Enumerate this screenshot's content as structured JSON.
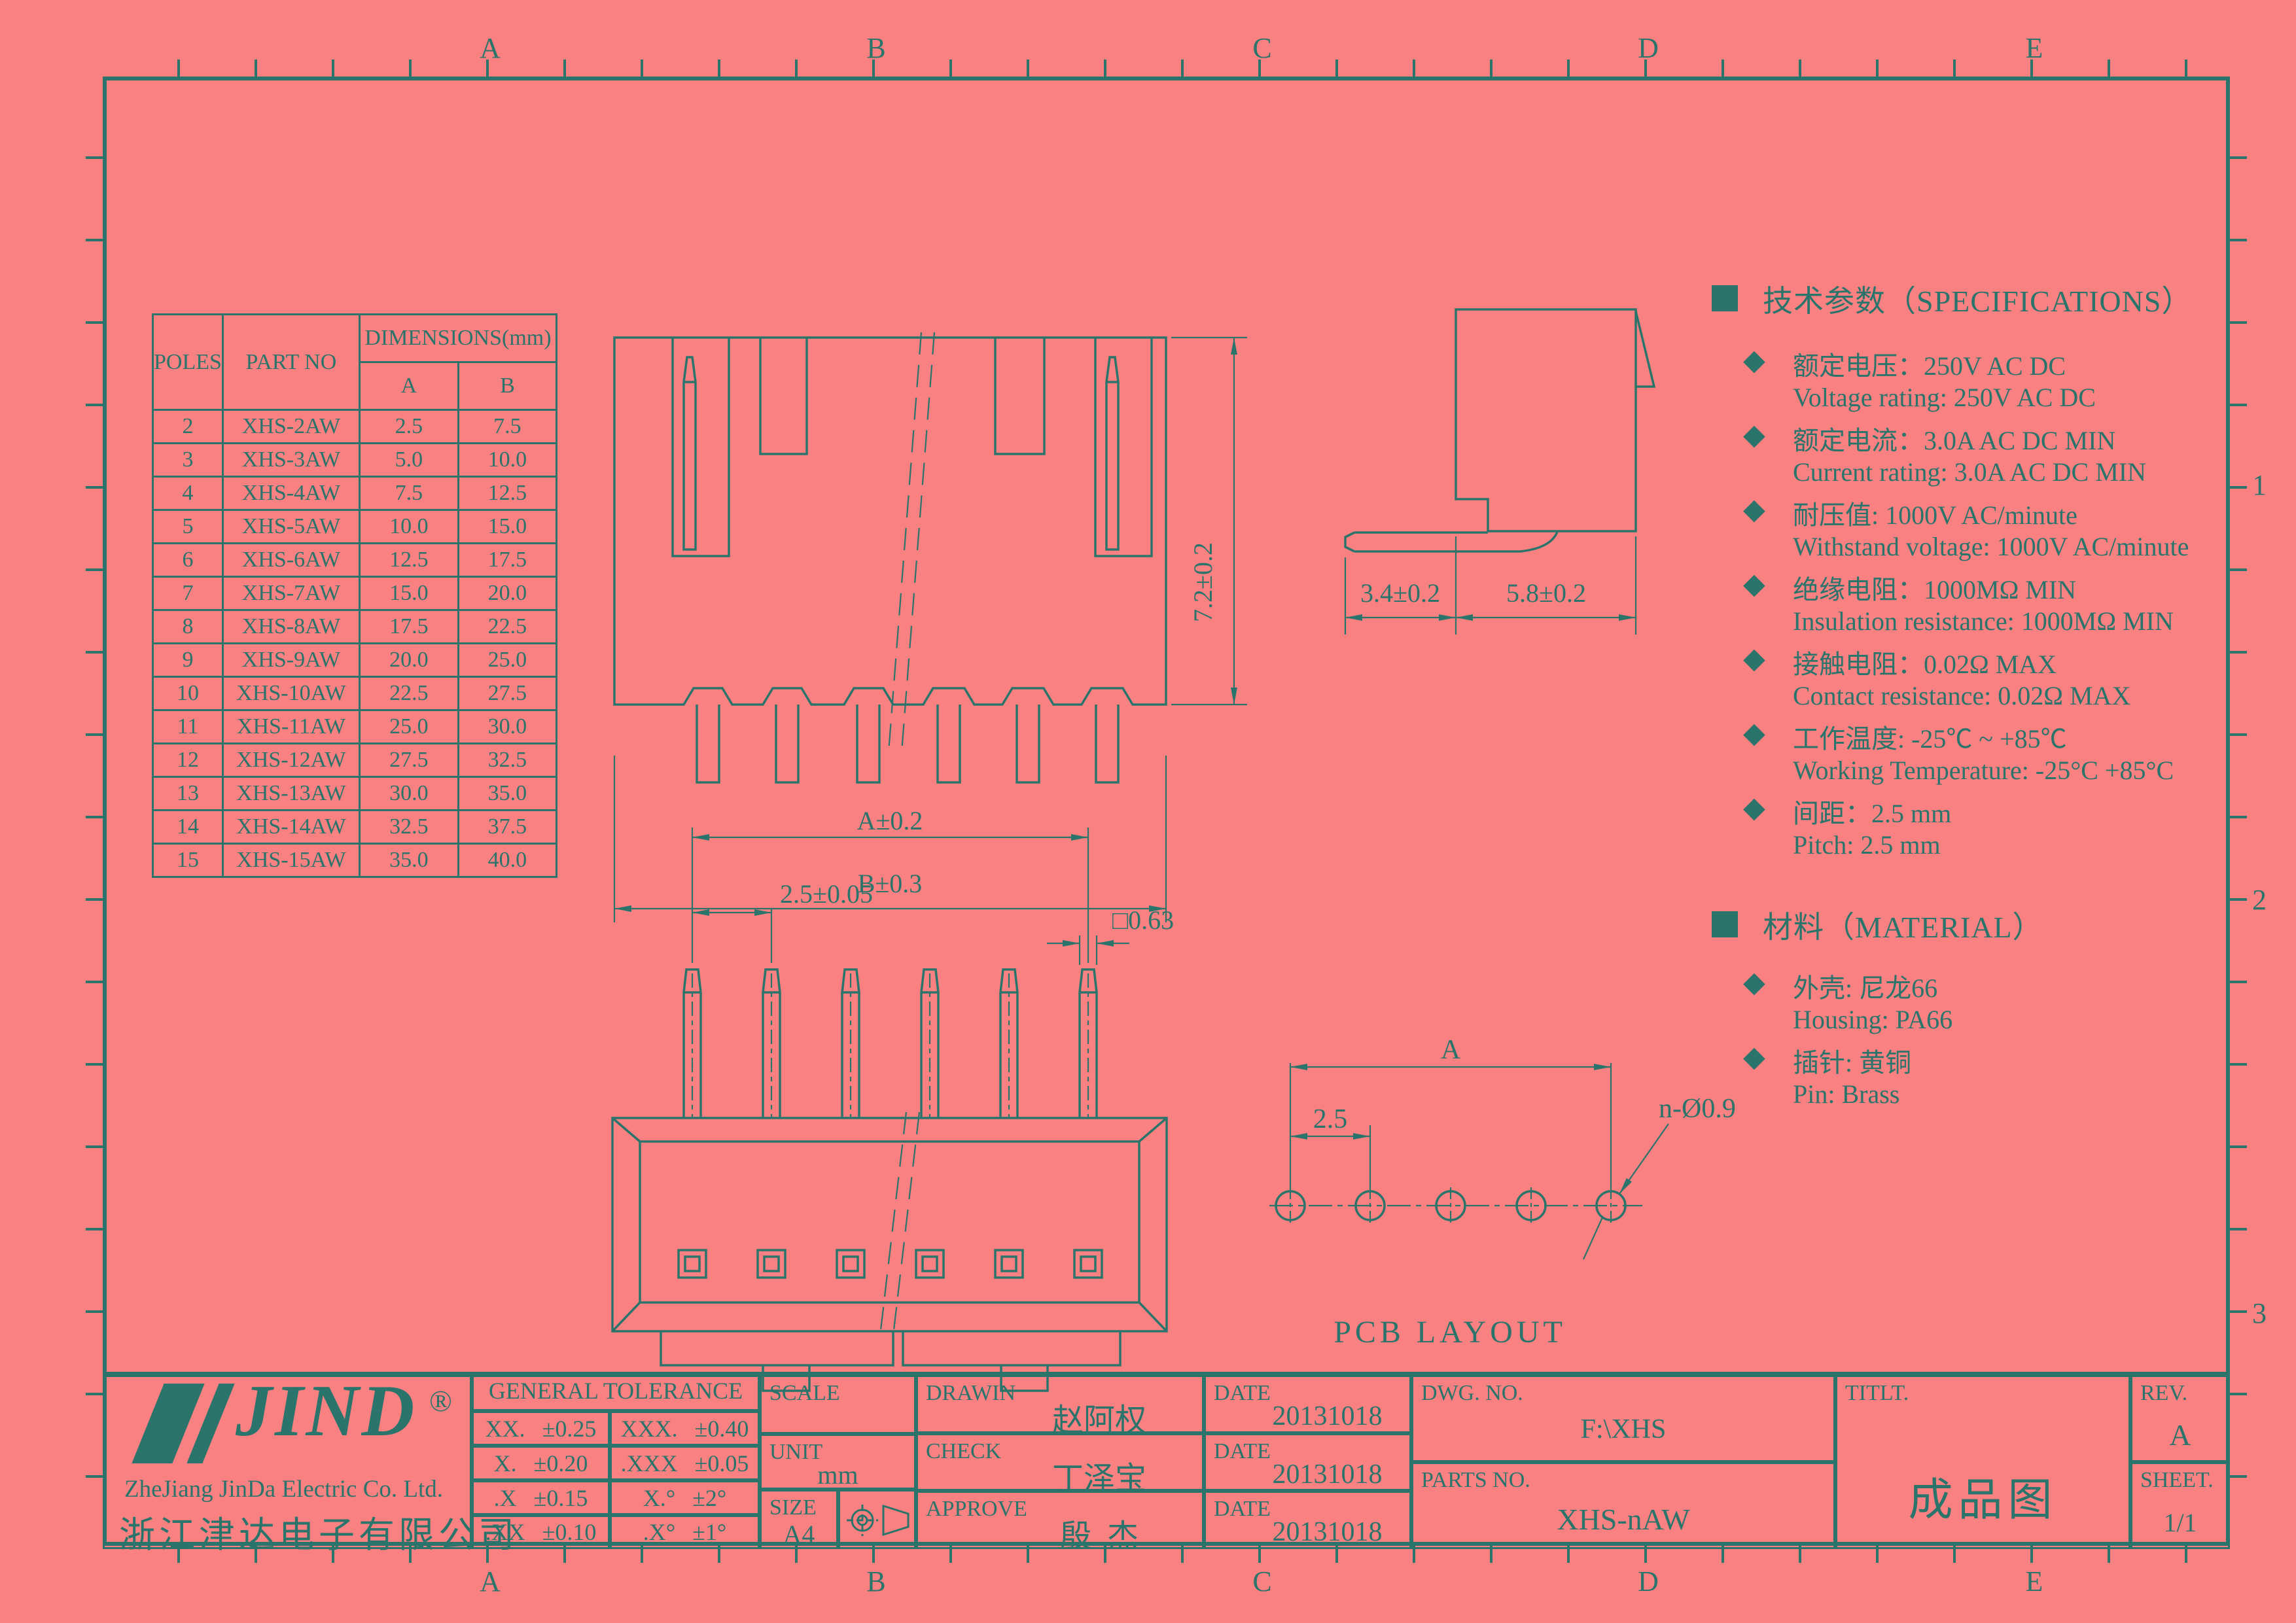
{
  "sheet": {
    "zone_letters": [
      "A",
      "B",
      "C",
      "D",
      "E"
    ],
    "zone_numbers": [
      "1",
      "2",
      "3"
    ],
    "colors": {
      "background": "#f98181",
      "ink": "#2a746c"
    }
  },
  "dimension_table": {
    "header_poles": "POLES",
    "header_part": "PART NO",
    "header_dims": "DIMENSIONS(mm)",
    "header_a": "A",
    "header_b": "B",
    "rows": [
      {
        "poles": "2",
        "part": "XHS-2AW",
        "a": "2.5",
        "b": "7.5"
      },
      {
        "poles": "3",
        "part": "XHS-3AW",
        "a": "5.0",
        "b": "10.0"
      },
      {
        "poles": "4",
        "part": "XHS-4AW",
        "a": "7.5",
        "b": "12.5"
      },
      {
        "poles": "5",
        "part": "XHS-5AW",
        "a": "10.0",
        "b": "15.0"
      },
      {
        "poles": "6",
        "part": "XHS-6AW",
        "a": "12.5",
        "b": "17.5"
      },
      {
        "poles": "7",
        "part": "XHS-7AW",
        "a": "15.0",
        "b": "20.0"
      },
      {
        "poles": "8",
        "part": "XHS-8AW",
        "a": "17.5",
        "b": "22.5"
      },
      {
        "poles": "9",
        "part": "XHS-9AW",
        "a": "20.0",
        "b": "25.0"
      },
      {
        "poles": "10",
        "part": "XHS-10AW",
        "a": "22.5",
        "b": "27.5"
      },
      {
        "poles": "11",
        "part": "XHS-11AW",
        "a": "25.0",
        "b": "30.0"
      },
      {
        "poles": "12",
        "part": "XHS-12AW",
        "a": "27.5",
        "b": "32.5"
      },
      {
        "poles": "13",
        "part": "XHS-13AW",
        "a": "30.0",
        "b": "35.0"
      },
      {
        "poles": "14",
        "part": "XHS-14AW",
        "a": "32.5",
        "b": "37.5"
      },
      {
        "poles": "15",
        "part": "XHS-15AW",
        "a": "35.0",
        "b": "40.0"
      }
    ]
  },
  "views": {
    "front": {
      "dim_width": "B±0.3",
      "dim_height": "7.2±0.2"
    },
    "side": {
      "dim_pin": "3.4±0.2",
      "dim_body": "5.8±0.2"
    },
    "pin": {
      "dim_span": "A±0.2",
      "dim_pitch": "2.5±0.05",
      "dim_square": "□0.63"
    },
    "pcb": {
      "dim_span": "A",
      "dim_pitch": "2.5",
      "hole_callout": "n-Ø0.9",
      "caption": "PCB LAYOUT"
    }
  },
  "specifications": {
    "item_bullet": "◆",
    "title": "技术参数（SPECIFICATIONS）",
    "items": [
      {
        "zh": "额定电压：250V AC DC",
        "en": "Voltage rating: 250V AC DC"
      },
      {
        "zh": "额定电流：3.0A AC DC  MIN",
        "en": "Current rating: 3.0A  AC DC  MIN"
      },
      {
        "zh": "耐压值: 1000V AC/minute",
        "en": "Withstand voltage: 1000V AC/minute"
      },
      {
        "zh": "绝缘电阻：1000MΩ  MIN",
        "en": "Insulation resistance: 1000MΩ  MIN"
      },
      {
        "zh": "接触电阻：0.02Ω  MAX",
        "en": "Contact resistance:  0.02Ω  MAX"
      },
      {
        "zh": "工作温度: -25℃ ~ +85℃",
        "en": "Working Temperature: -25°C  +85°C"
      },
      {
        "zh": "间距：2.5 mm",
        "en": "Pitch: 2.5 mm"
      }
    ]
  },
  "material": {
    "item_bullet": "◆",
    "title": "材料（MATERIAL）",
    "items": [
      {
        "zh": "外壳: 尼龙66",
        "en": "Housing:  PA66"
      },
      {
        "zh": "插针: 黄铜",
        "en": "Pin: Brass"
      }
    ]
  },
  "title_block": {
    "company": {
      "logo_text": "JIND",
      "registered": "®",
      "name_en": "ZheJiang JinDa Electric Co. Ltd.",
      "name_zh": "浙江津达电子有限公司"
    },
    "tolerance": {
      "title": "GENERAL  TOLERANCE",
      "rows": [
        [
          "XX.",
          "±0.25",
          "XXX.",
          "±0.40"
        ],
        [
          "X.",
          "±0.20",
          ".XXX",
          "±0.05"
        ],
        [
          ".X",
          "±0.15",
          "X.°",
          "±2°"
        ],
        [
          ".XX",
          "±0.10",
          ".X°",
          "±1°"
        ]
      ]
    },
    "scale": {
      "label": "SCALE",
      "value": ""
    },
    "unit": {
      "label": "UNIT",
      "value": "mm"
    },
    "size": {
      "label": "SIZE",
      "value": "A4"
    },
    "drawin": {
      "label": "DRAWIN",
      "name": "赵阿权",
      "date_label": "DATE",
      "date": "20131018"
    },
    "check": {
      "label": "CHECK",
      "name": "丁泽宝",
      "date_label": "DATE",
      "date": "20131018"
    },
    "approve": {
      "label": "APPROVE",
      "name": "殷  杰",
      "date_label": "DATE",
      "date": "20131018"
    },
    "dwg_no": {
      "label": "DWG.  NO.",
      "value": "F:\\XHS"
    },
    "parts_no": {
      "label": "PARTS  NO.",
      "value": "XHS-nAW"
    },
    "titlt": {
      "label": "TITLT.",
      "value": "成品图"
    },
    "rev": {
      "label": "REV.",
      "value": "A"
    },
    "sheet": {
      "label": "SHEET.",
      "value": "1/1"
    }
  }
}
